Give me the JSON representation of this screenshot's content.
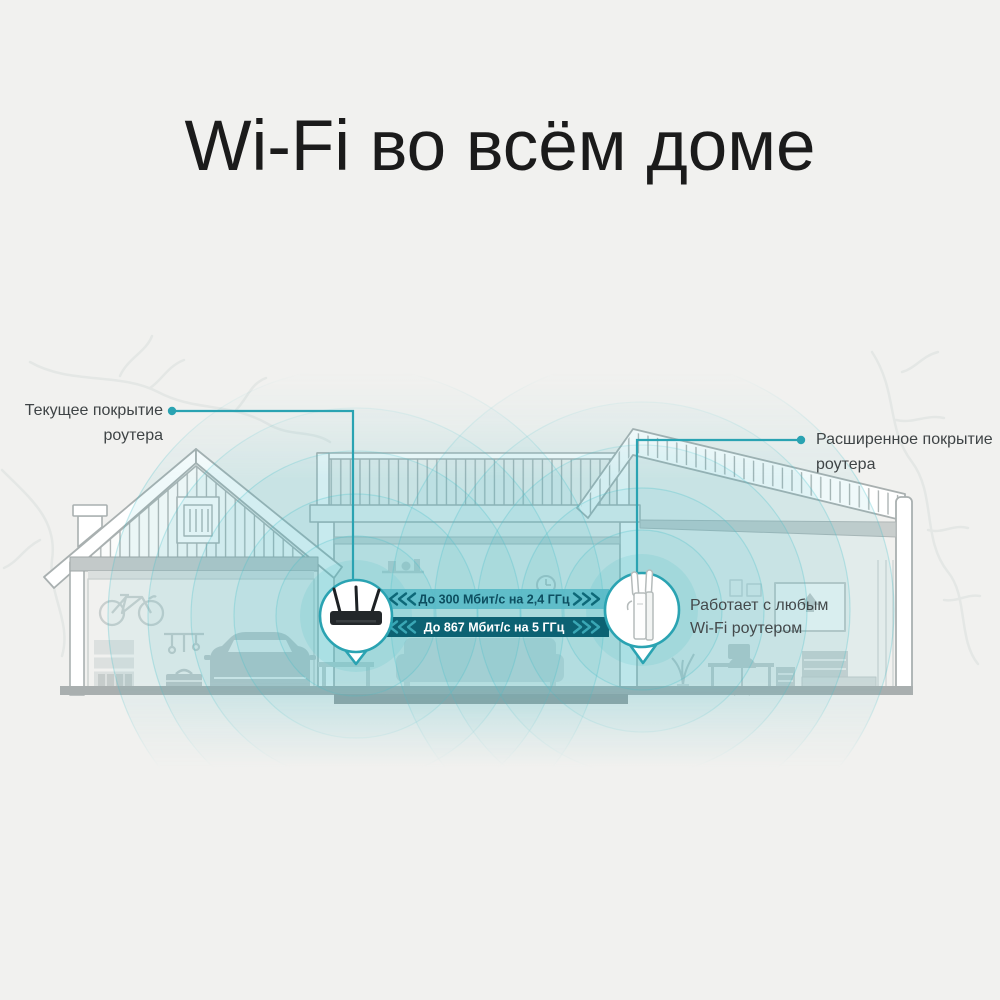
{
  "title": "Wi-Fi во всём доме",
  "callouts": {
    "left": {
      "lines": [
        "Текущее покрытие",
        "роутера"
      ]
    },
    "right": {
      "lines": [
        "Расширенное покрытие",
        "роутера"
      ]
    }
  },
  "speed_bars": [
    {
      "label": "До 300 Мбит/с на 2,4 ГГц"
    },
    {
      "label": "До 867 Мбит/с на 5 ГГц"
    }
  ],
  "extender_note": {
    "lines": [
      "Работает с любым",
      "Wi-Fi роутером"
    ]
  },
  "icons": {
    "router": "router-icon",
    "extender": "extender-icon",
    "chevrons_left": "chevrons-left-icon",
    "chevrons_right": "chevrons-right-icon",
    "callout_dot": "callout-dot-icon"
  },
  "colors": {
    "background": "#f1f1ef",
    "accent_teal": "#2aa3b2",
    "wave_teal": "#4abfca",
    "bar_light_bg": "#57b9c6",
    "bar_light_text": "#0d4e60",
    "bar_dark_bg": "#0c6273",
    "bar_dark_text": "#ffffff",
    "line_gray": "#a9b0b0",
    "title_color": "#1b1b1b"
  }
}
